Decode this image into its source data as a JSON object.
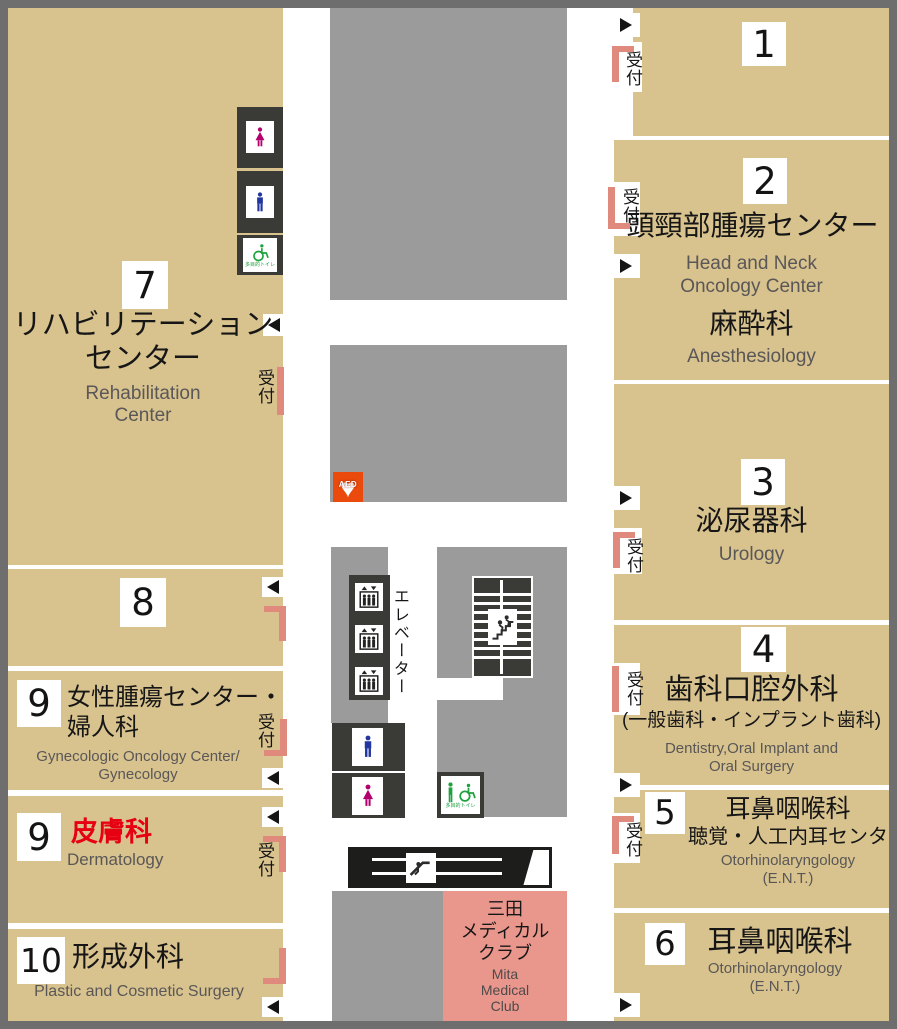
{
  "colors": {
    "tan": "#d8c28e",
    "gray": "#9b9b9b",
    "dark": "#3a3a37",
    "frame": "#6e6e6e",
    "pink": "#e08a7e",
    "mita": "#e9978c",
    "red": "#e60012",
    "aed": "#ea4a0c",
    "blue": "#2336a0",
    "magenta": "#b2006e",
    "green": "#1fa23e",
    "graytext": "#595757"
  },
  "reception_label": "受付",
  "left": {
    "sections": [
      {
        "number": "7",
        "ja": [
          "リハビリテーション",
          "センター"
        ],
        "en": [
          "Rehabilitation",
          "Center"
        ]
      },
      {
        "number": "8"
      },
      {
        "number": "9",
        "ja": [
          "女性腫瘍センター・",
          "婦人科"
        ],
        "en": [
          "Gynecologic Oncology Center/",
          "Gynecology"
        ]
      },
      {
        "number": "9",
        "ja": [
          "皮膚科"
        ],
        "en": [
          "Dermatology"
        ]
      },
      {
        "number": "10",
        "ja": [
          "形成外科"
        ],
        "en": [
          "Plastic and Cosmetic Surgery"
        ]
      }
    ]
  },
  "right": {
    "sections": [
      {
        "number": "1"
      },
      {
        "number": "2",
        "ja": [
          "頭頸部腫瘍センター"
        ],
        "en": [
          "Head and Neck",
          "Oncology Center"
        ],
        "ja2": [
          "麻酔科"
        ],
        "en2": [
          "Anesthesiology"
        ]
      },
      {
        "number": "3",
        "ja": [
          "泌尿器科"
        ],
        "en": [
          "Urology"
        ]
      },
      {
        "number": "4",
        "ja": [
          "歯科口腔外科",
          "(一般歯科・インプラント歯科)"
        ],
        "en": [
          "Dentistry,Oral Implant and",
          "Oral Surgery"
        ]
      },
      {
        "number": "5",
        "ja": [
          "耳鼻咽喉科",
          "聴覚・人工内耳センター"
        ],
        "en": [
          "Otorhinolaryngology",
          "(E.N.T.)"
        ]
      },
      {
        "number": "6",
        "ja": [
          "耳鼻咽喉科"
        ],
        "en": [
          "Otorhinolaryngology",
          "(E.N.T.)"
        ]
      }
    ]
  },
  "middle": {
    "elevator_label": "エレベーター",
    "aed_label": "AED",
    "accessible_toilet_label": "多目的トイレ",
    "mita": {
      "ja": [
        "三田",
        "メディカル",
        "クラブ"
      ],
      "en": [
        "Mita",
        "Medical",
        "Club"
      ]
    }
  }
}
